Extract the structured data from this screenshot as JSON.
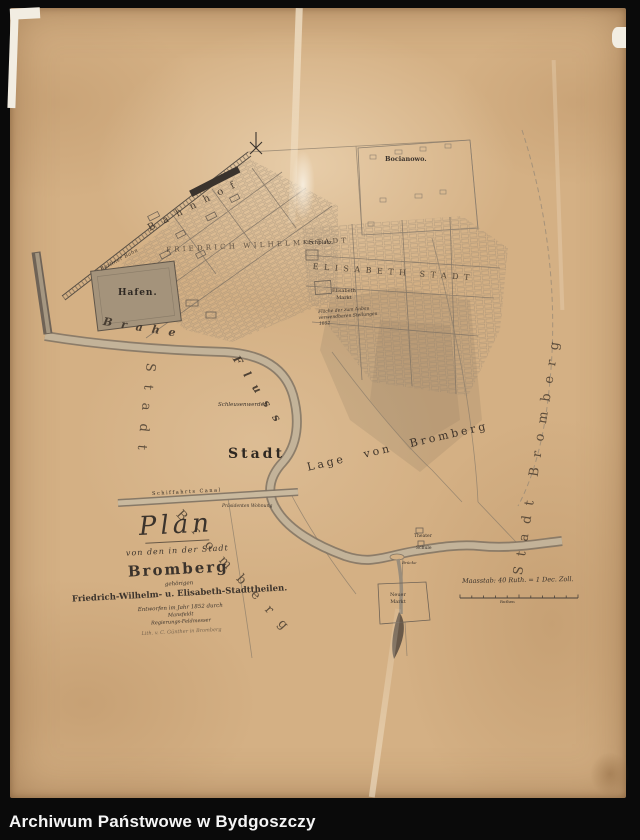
{
  "archive_bar": {
    "title": "Archiwum Państwowe w Bydgoszczy"
  },
  "map": {
    "title_block": {
      "plan": "Plan",
      "subtitle1": "von den in der Stadt",
      "city": "Bromberg",
      "subtitle2": "gehörigen",
      "districts_line": "Friedrich-Wilhelm- u. Elisabeth-Stadttheilen.",
      "credit1": "Entworfen im Jahr 1852 durch",
      "credit2": "Mansfeldt",
      "credit3": "Regierungs-Feldmesser",
      "credit4": "Lith. v. C. Günther in Bromberg"
    },
    "district_labels": {
      "friedrich_wilhelm": "FRIEDRICH WILHELM STADT",
      "elisabeth": "ELISABETH STADT",
      "bocianowo": "Bocianowo."
    },
    "periphery_labels": {
      "left_vertical": "Stadt",
      "bottom_arc": "Bromberg",
      "right_vertical": "Stadt Bromberg",
      "center_word": "Stadt",
      "center_phrase": "Lage von Bromberg"
    },
    "river_labels": {
      "upper": "Brahe",
      "lower": "Fluss"
    },
    "place_labels": {
      "hafen": "Hafen.",
      "bahnhof": "Bahnhof",
      "bahn_line": "Berliner Bahn",
      "kirchplatz": "Kirchplatz.",
      "elisabeth_markt_1": "Elisabeth",
      "elisabeth_markt_2": "Markt",
      "neuer_markt_1": "Neuer",
      "neuer_markt_2": "Markt",
      "werder": "Schleusenwerder",
      "canal": "Schiffahrts Canal",
      "praesidenten_wohnung": "Präsidenten Wohnung",
      "theater": "Theater",
      "schule": "Schule",
      "bruecke": "Brücke"
    },
    "note_block": {
      "l1": "Fläche der zum Anbau",
      "l2": "verwendbaren Stellungen",
      "l3": "1852"
    },
    "scale": {
      "caption": "Maasstab: 40 Ruth. = 1 Dec. Zoll.",
      "unit": "Ruthen"
    }
  },
  "colors": {
    "paper": "#d4b084",
    "ink": "#3b332c",
    "river": "#c3b399",
    "frame": "#0a0a0a",
    "footer_text": "#f5f5f5"
  }
}
